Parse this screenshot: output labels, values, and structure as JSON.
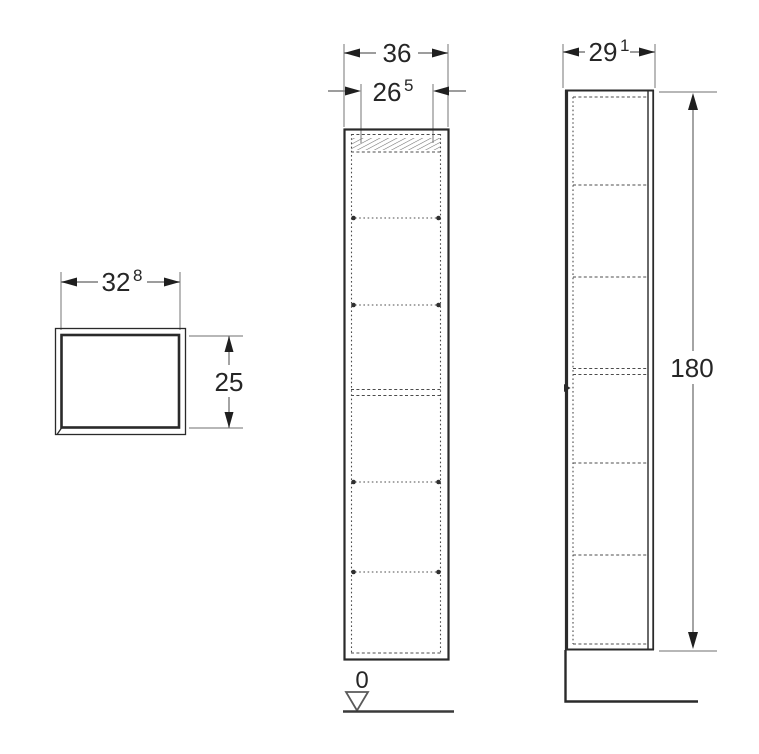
{
  "page": {
    "title": "Tall cabinet dimension drawing",
    "colors": {
      "ink": "#2a2a2a",
      "dimension_line": "#7d7d7d",
      "background": "#ffffff"
    }
  },
  "drawing": {
    "top_view": {
      "width": {
        "value": "32",
        "sup": "8"
      },
      "depth": {
        "value": "25",
        "sup": ""
      }
    },
    "front_view": {
      "overall_width": {
        "value": "36",
        "sup": ""
      },
      "inner_width": {
        "value": "26",
        "sup": "5"
      },
      "datum": {
        "value": "0"
      }
    },
    "side_view": {
      "depth": {
        "value": "29",
        "sup": "1"
      },
      "height": {
        "value": "180",
        "sup": ""
      }
    }
  }
}
